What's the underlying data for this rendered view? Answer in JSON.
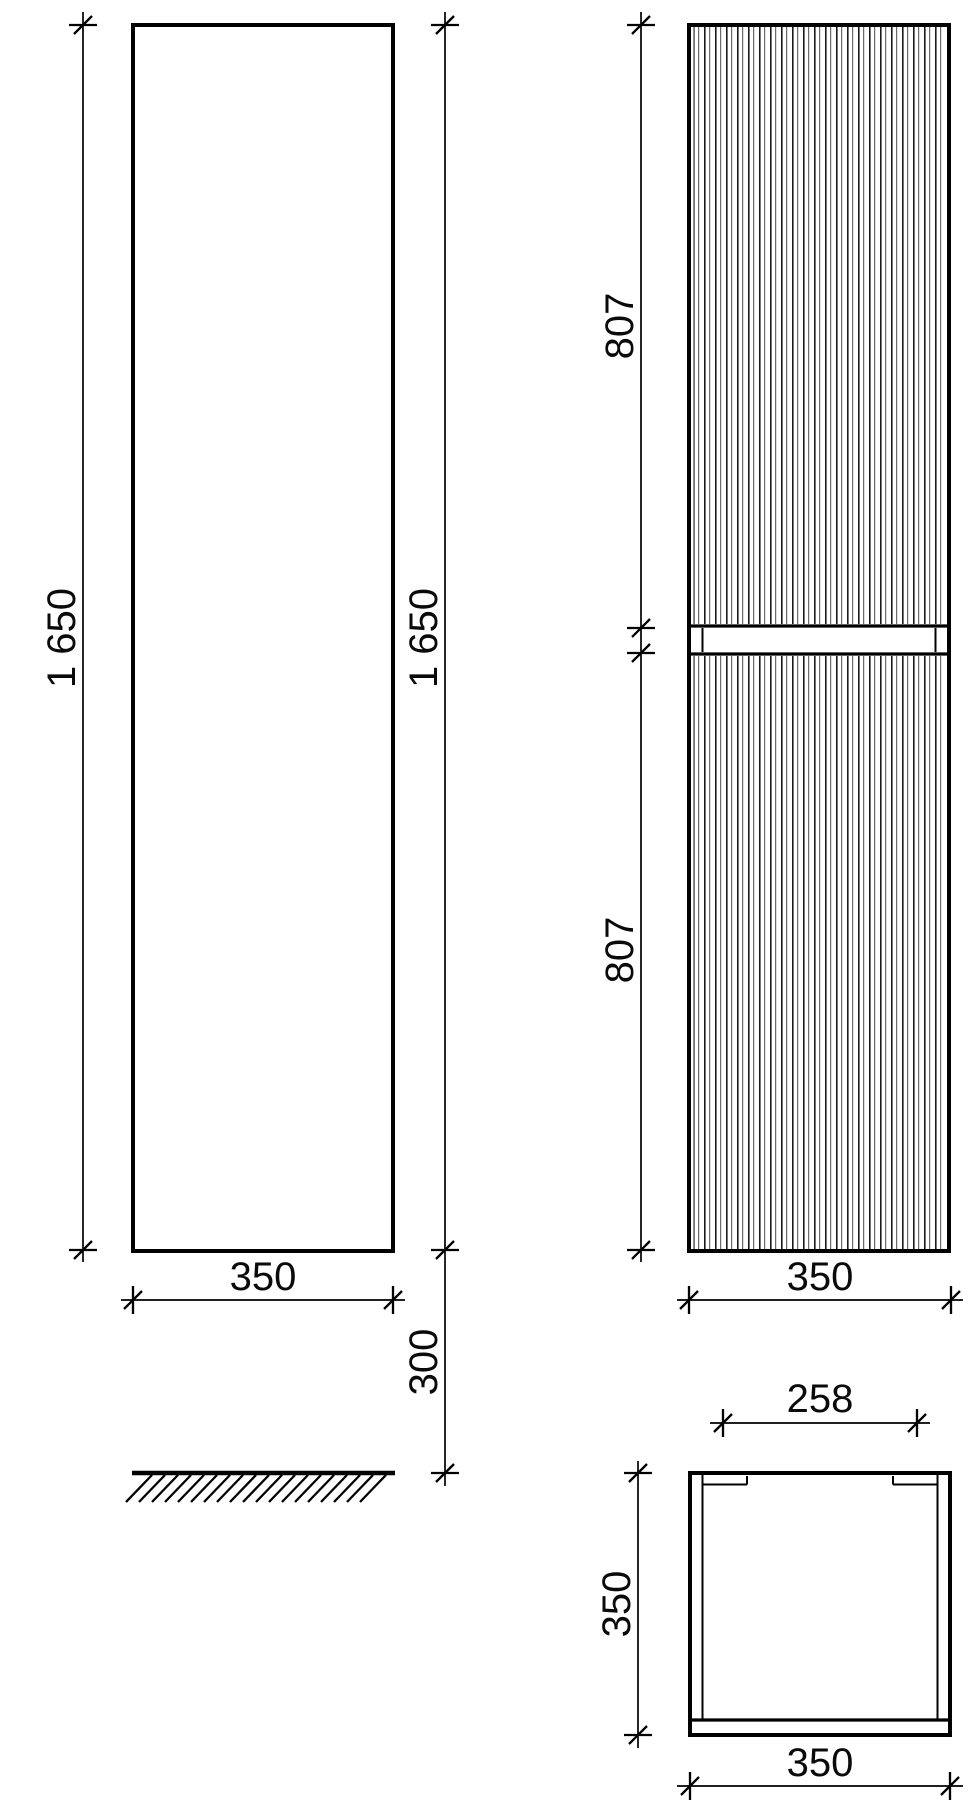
{
  "page": {
    "background": "#ffffff",
    "line_color": "#000000"
  },
  "views": {
    "side": {
      "height": "1 650",
      "height_right": "1 650",
      "width": "350",
      "floor_gap": "300"
    },
    "front": {
      "door_top": "807",
      "door_bottom": "807",
      "width": "350"
    },
    "top": {
      "inner_width": "258",
      "depth": "350",
      "width": "350"
    }
  }
}
